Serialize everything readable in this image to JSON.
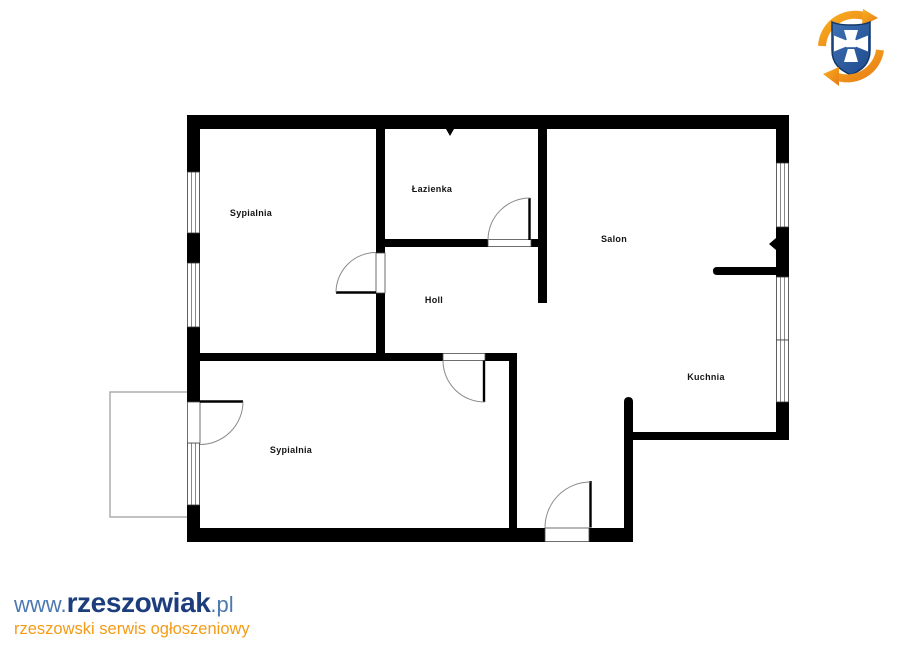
{
  "page": {
    "background_color": "#ffffff"
  },
  "floor_plan": {
    "wall_color": "#000000",
    "door_arc_color": "#8a8a8a",
    "balcony_outline_color": "#a8a8a8",
    "rooms": [
      {
        "id": "sypialnia-1",
        "label": "Sypialnia"
      },
      {
        "id": "lazienka",
        "label": "Łazienka"
      },
      {
        "id": "salon",
        "label": "Salon"
      },
      {
        "id": "holl",
        "label": "Holl"
      },
      {
        "id": "kuchnia",
        "label": "Kuchnia"
      },
      {
        "id": "sypialnia-2",
        "label": "Sypialnia"
      }
    ]
  },
  "branding": {
    "logo_icon": "rzeszowiak-crest-logo",
    "logo_colors": {
      "shield_blue": "#2d5aa4",
      "shield_border": "#143768",
      "cross_white": "#ffffff",
      "arrow_orange": "#f39c1a"
    },
    "watermark": {
      "url_prefix": "www.",
      "brand": "rzeszowiak",
      "url_suffix": ".pl",
      "tagline": "rzeszowski serwis ogłoszeniowy",
      "prefix_color": "#4d79b0",
      "brand_color": "#1d3e7c",
      "tagline_color": "#f59b15"
    }
  }
}
